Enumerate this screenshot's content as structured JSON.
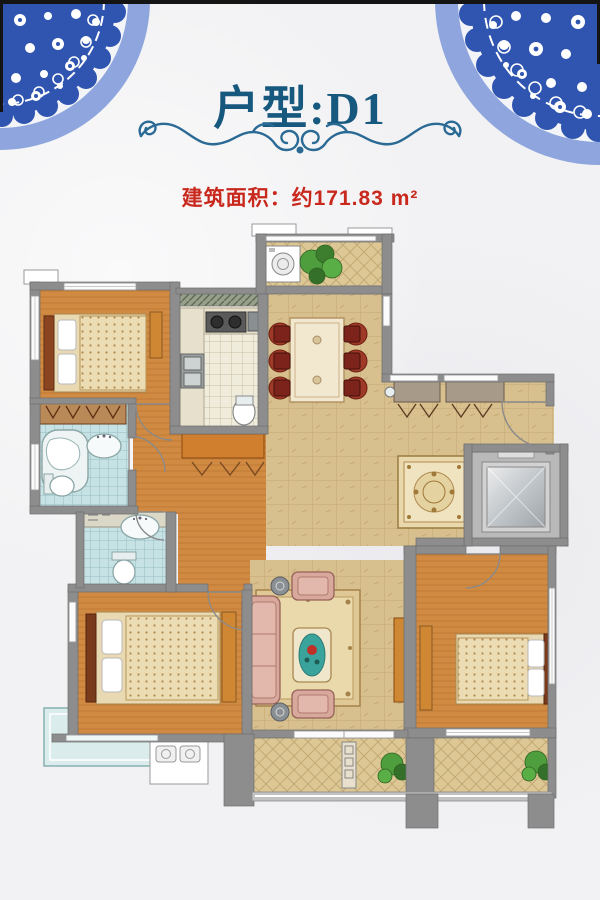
{
  "header": {
    "title": "户型:D1",
    "area_label": "建筑面积：约171.83 m²"
  },
  "palette": {
    "title_blue": "#17587f",
    "area_red": "#c9281d",
    "flourish_blue": "#2a6a95",
    "porcelain_blue": "#2f55b0",
    "porcelain_light": "#8ea6dd",
    "wall_gray": "#8d8d8d",
    "wood": "#d08a42",
    "wood_dark": "#cf8733",
    "tile_tan": "#d7bf8e",
    "tile_balcony": "#dcc795",
    "kitchen_tile": "#f0ecdc",
    "bath_tile": "#c6e2e4",
    "sofa_pink": "#d8a89c",
    "rug_beige": "#e8d8ac",
    "bed_linen": "#e9d9b2",
    "chair_red": "#7c241c",
    "teal_decor": "#3aa49c",
    "plant_green": "#4f9e3d",
    "elevator_gray": "#b9b9b9"
  },
  "floor_plan": {
    "rooms": [
      "bedroom-top-left",
      "master-bedroom",
      "bedroom-right",
      "living-room",
      "dining-room",
      "kitchen",
      "bathroom-ensuite",
      "bathroom-common",
      "entry-foyer",
      "elevator",
      "balcony-top",
      "balcony-bottom",
      "bay-window"
    ],
    "furniture": [
      "double-bed",
      "dining-table-six-chairs",
      "sofa-set",
      "coffee-table",
      "tv-cabinet",
      "wardrobe",
      "bathtub",
      "toilet",
      "washbasin",
      "kitchen-stove",
      "kitchen-sink",
      "washing-machine",
      "potted-plant",
      "area-rug",
      "foyer-rug",
      "air-conditioner-platform"
    ],
    "decorations": [
      "porcelain-medallion-top-left",
      "porcelain-medallion-top-right",
      "scroll-flourish"
    ]
  }
}
